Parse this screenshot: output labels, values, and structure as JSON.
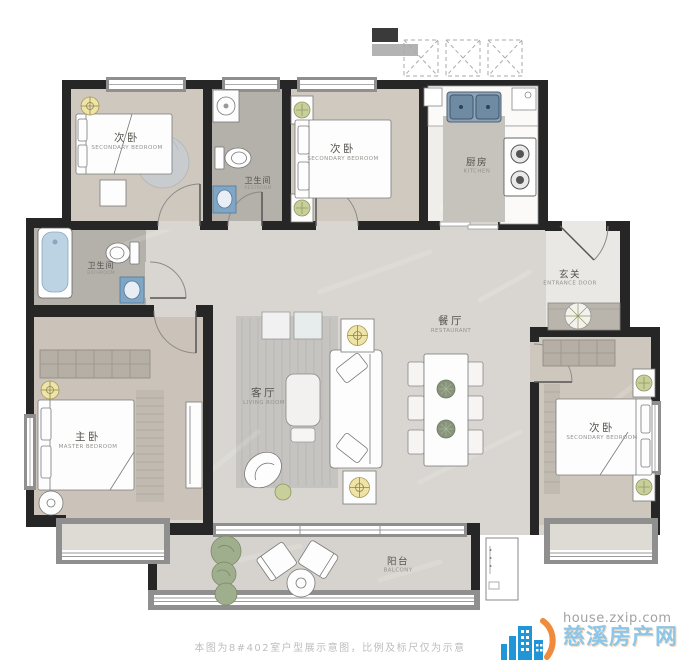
{
  "meta": {
    "type": "apartment-floor-plan"
  },
  "plan": {
    "rooms": [
      {
        "key": "bedroom-top-left",
        "zh": "次卧",
        "en": "SECONDARY BEDROOM"
      },
      {
        "key": "restroom-top",
        "zh": "卫生间",
        "en": "RESTROOM"
      },
      {
        "key": "bedroom-top-middle",
        "zh": "次卧",
        "en": "SECONDARY BEDROOM"
      },
      {
        "key": "kitchen",
        "zh": "厨房",
        "en": "KITCHEN"
      },
      {
        "key": "entrance",
        "zh": "玄关",
        "en": "ENTRANCE DOOR"
      },
      {
        "key": "dining-room",
        "zh": "餐厅",
        "en": "RESTAURANT"
      },
      {
        "key": "living-room",
        "zh": "客厅",
        "en": "LIVING ROOM"
      },
      {
        "key": "bathroom-left",
        "zh": "卫生间",
        "en": "BATHROOM"
      },
      {
        "key": "master-bedroom",
        "zh": "主卧",
        "en": "MASTER BEDROOM"
      },
      {
        "key": "bedroom-right",
        "zh": "次卧",
        "en": "SECONDARY BEDROOM"
      },
      {
        "key": "balcony",
        "zh": "阳台",
        "en": "BALCONY"
      }
    ]
  },
  "footer": {
    "disclaimer": "本图为8#402室户型展示意图，比例及标尺仅为示意"
  },
  "watermark": {
    "url": "house.zxip.com",
    "site": "慈溪房产网"
  },
  "colors": {
    "wall": "#262626",
    "window_frame": "#8f8f8f",
    "fixture_blue": "#7fa6c4",
    "plant_green": "#9fae8c",
    "symbol_yellow": "#efe3a6",
    "watermark_blue": "#8cc6e8",
    "watermark_orange": "#f08a3c",
    "disclaimer_gray": "#bdbdbd"
  }
}
